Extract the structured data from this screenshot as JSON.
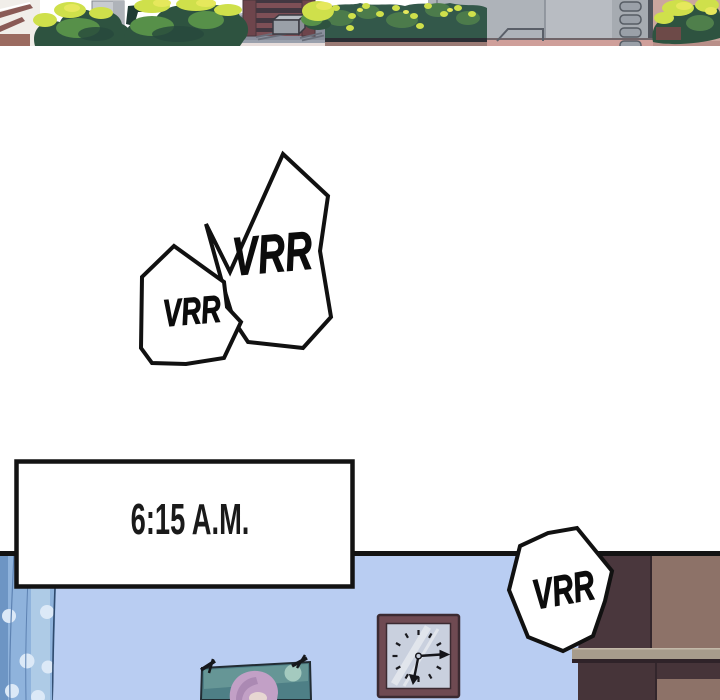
{
  "comic": {
    "sfx": {
      "bubble_large_text": "VRR",
      "bubble_small_text": "VRR",
      "bubble_right_text": "VRR"
    },
    "caption": {
      "time_text": "6:15 A.M."
    }
  },
  "palette": {
    "ink": "#131313",
    "paper": "#ffffff",
    "bubble_fill": "#ffffff",
    "wall_blue": "#b9cdf2",
    "curtain_base": "#8fb3dc",
    "curtain_light": "#aecbe6",
    "curtain_dark": "#6d95c4",
    "curtain_dot": "#dce9f7",
    "wardrobe_dark": "#4a373d",
    "wardrobe_light": "#8d7268",
    "shelf": "#a79c8c",
    "clock_frame": "#6f4a52",
    "clock_face": "#c9d0de",
    "poster_bg": "#4e7f86",
    "poster_hair": "#c2a0c6",
    "pavement": "#8a8f9d",
    "bush_dark": "#2e5340",
    "bush_mid": "#579049",
    "bush_bright": "#cfe04b",
    "bush_yellow": "#e6e85c",
    "hedge": "#33584a",
    "building_maroon": "#7d4f56",
    "gray_wall": "#aeb3b9",
    "gray_wall_light": "#b8bcc2",
    "pink_wall": "#cba69e",
    "pink_ground": "#cf9f9a",
    "steps_white": "#f1eee9",
    "steps_maroon": "#8a5a55"
  }
}
